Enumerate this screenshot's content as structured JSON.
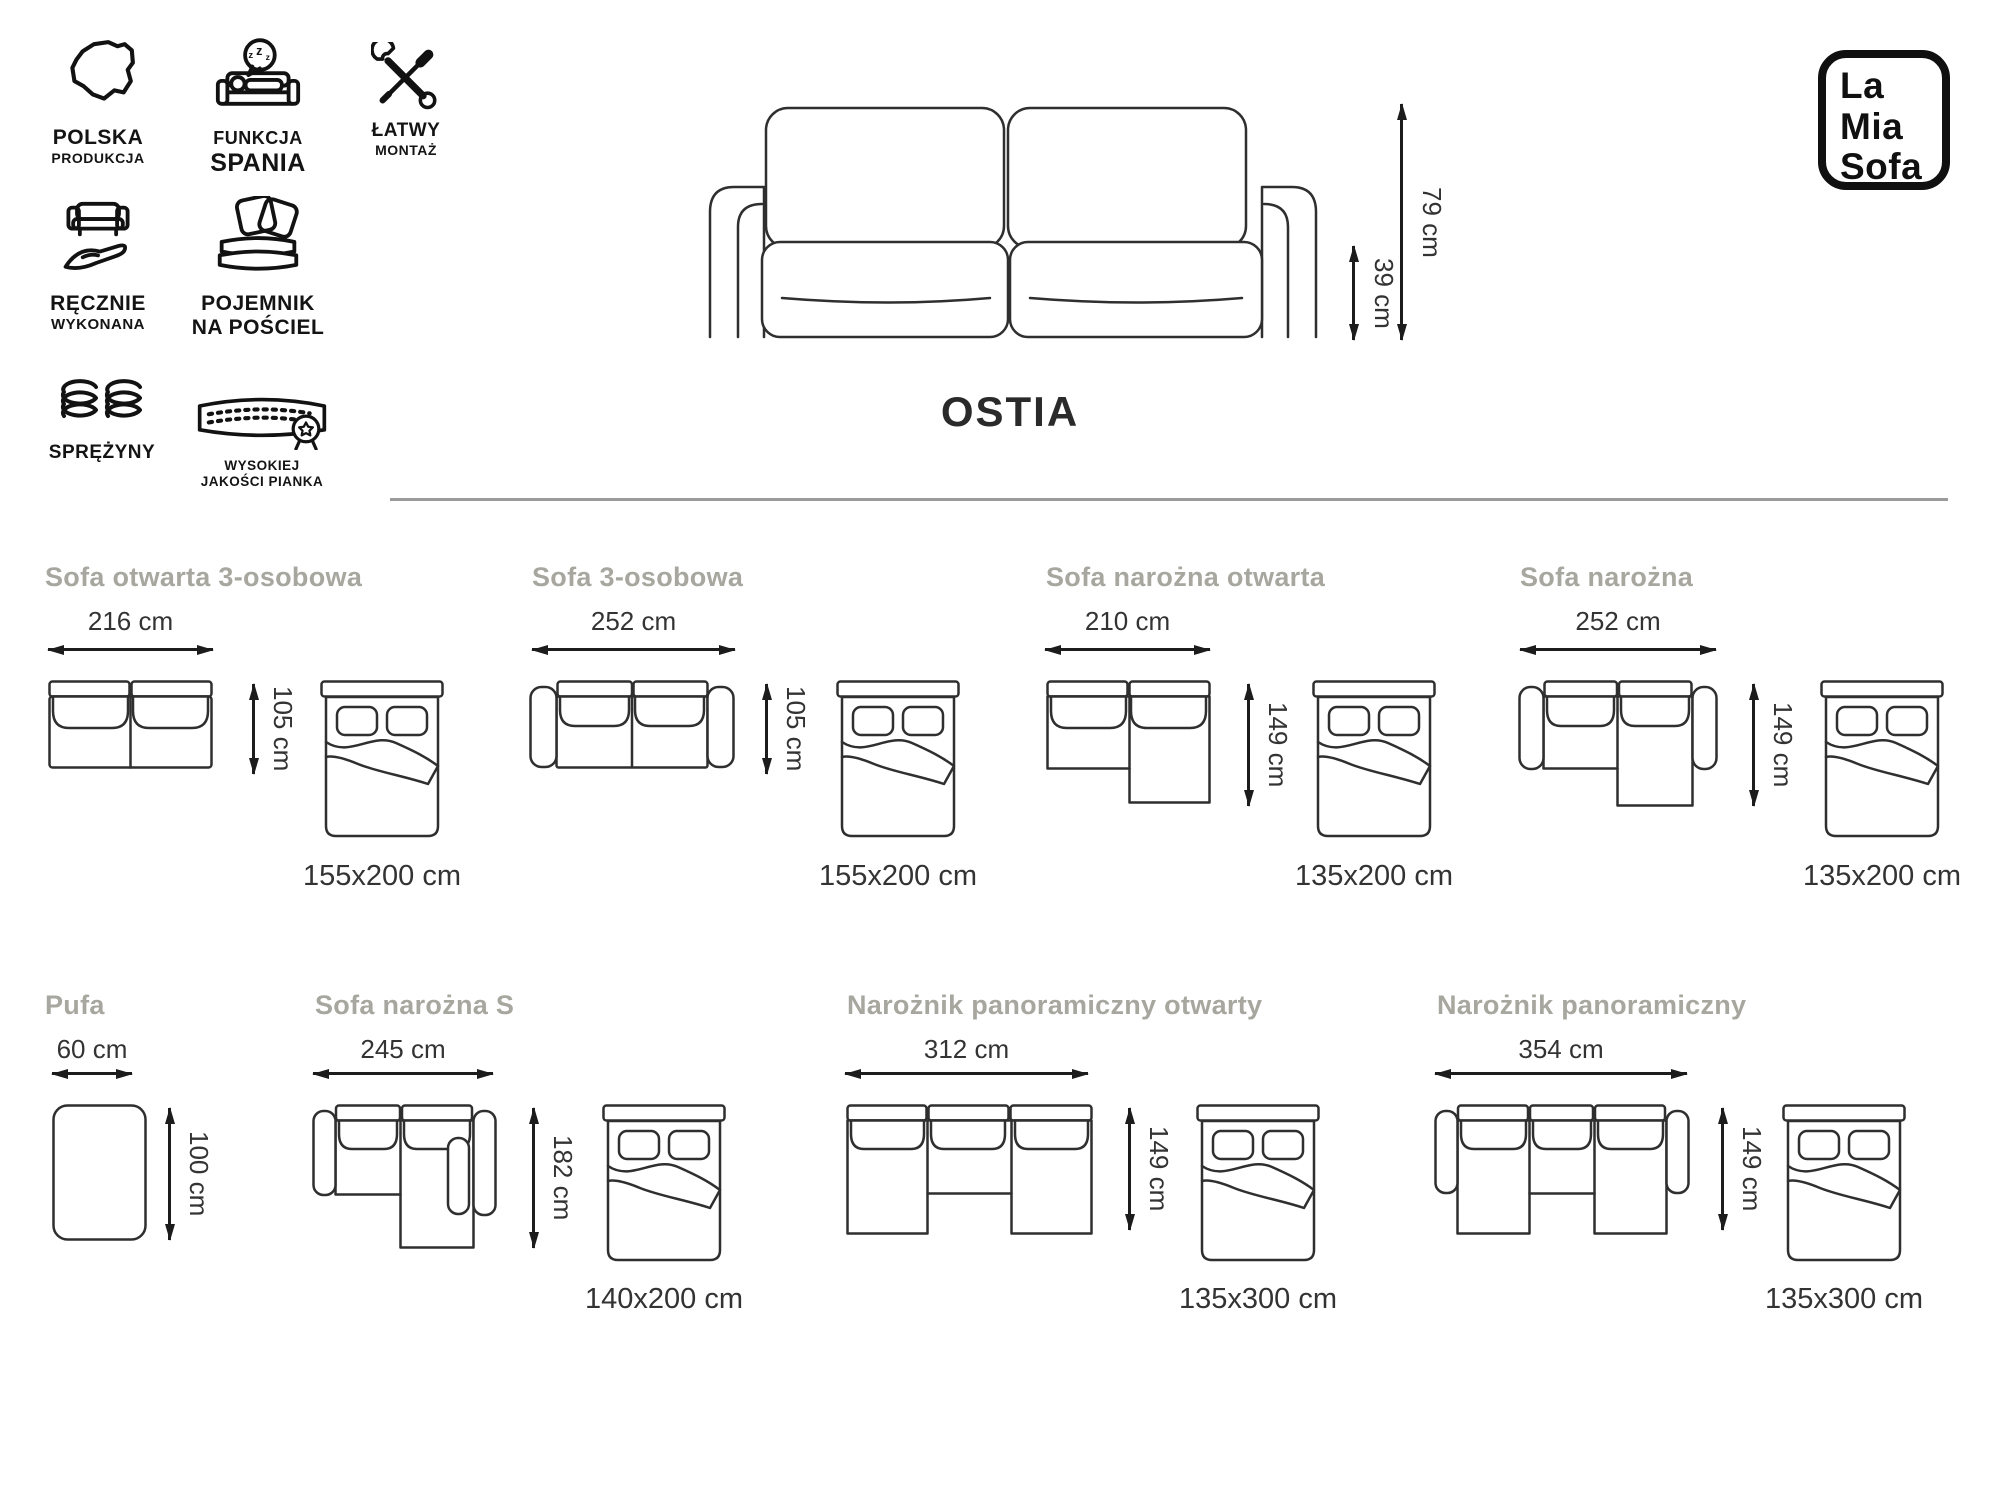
{
  "brand": {
    "line1": "La",
    "line2": "Mia",
    "line3": "Sofa"
  },
  "product": {
    "name": "OSTIA",
    "height": "79 cm",
    "seat_height": "39 cm"
  },
  "features": [
    {
      "line1": "POLSKA",
      "line2": "PRODUKCJA",
      "icon": "poland-map-icon"
    },
    {
      "line1": "FUNKCJA",
      "line2": "SPANIA",
      "icon": "sleep-function-icon"
    },
    {
      "line1": "ŁATWY",
      "line2": "MONTAŻ",
      "icon": "easy-assembly-tools-icon"
    },
    {
      "line1": "RĘCZNIE",
      "line2": "WYKONANA",
      "icon": "handmade-icon"
    },
    {
      "line1": "POJEMNIK",
      "line2": "NA POŚCIEL",
      "icon": "bedding-container-icon"
    },
    {
      "line1": "SPRĘŻYNY",
      "line2": "",
      "icon": "springs-icon"
    },
    {
      "line1": "WYSOKIEJ",
      "line2": "JAKOŚCI PIANKA",
      "icon": "foam-quality-icon"
    }
  ],
  "variants": [
    {
      "name": "Sofa otwarta 3-osobowa",
      "width": "216 cm",
      "depth": "105 cm",
      "bed": "155x200 cm"
    },
    {
      "name": "Sofa 3-osobowa",
      "width": "252 cm",
      "depth": "105 cm",
      "bed": "155x200 cm"
    },
    {
      "name": "Sofa narożna otwarta",
      "width": "210 cm",
      "depth": "149 cm",
      "bed": "135x200 cm"
    },
    {
      "name": "Sofa narożna",
      "width": "252 cm",
      "depth": "149 cm",
      "bed": "135x200 cm"
    },
    {
      "name": "Pufa",
      "width": "60 cm",
      "depth": "100 cm",
      "bed": ""
    },
    {
      "name": "Sofa narożna S",
      "width": "245 cm",
      "depth": "182 cm",
      "bed": "140x200 cm"
    },
    {
      "name": "Narożnik panoramiczny otwarty",
      "width": "312 cm",
      "depth": "149 cm",
      "bed": "135x300 cm"
    },
    {
      "name": "Narożnik panoramiczny",
      "width": "354 cm",
      "depth": "149 cm",
      "bed": "135x300 cm"
    }
  ]
}
